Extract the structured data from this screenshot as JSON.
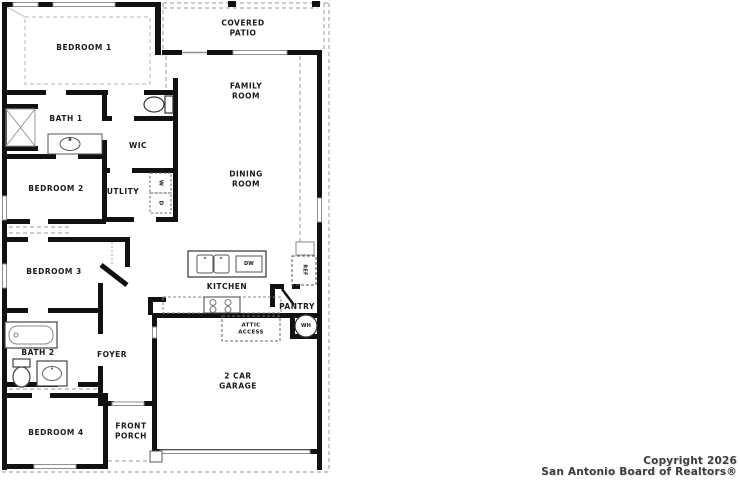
{
  "floorplan": {
    "rooms": {
      "bedroom1": "BEDROOM 1",
      "covered_patio": "COVERED\nPATIO",
      "family_room": "FAMILY\nROOM",
      "bath1": "BATH 1",
      "wic": "WIC",
      "bedroom2": "BEDROOM 2",
      "utility": "UTLITY",
      "dining_room": "DINING\nROOM",
      "bedroom3": "BEDROOM 3",
      "kitchen": "KITCHEN",
      "pantry": "PANTRY",
      "bath2": "BATH 2",
      "foyer": "FOYER",
      "attic_access": "ATTIC\nACCESS",
      "garage": "2 CAR\nGARAGE",
      "bedroom4": "BEDROOM 4",
      "front_porch": "FRONT\nPORCH"
    },
    "appliances": {
      "washer": "W",
      "dryer": "D",
      "dishwasher": "DW",
      "refrigerator": "REF",
      "water_heater": "WH"
    },
    "colors": {
      "wall": "#111111",
      "window": "#999999",
      "dashed_line": "#9a9a9a"
    }
  },
  "footer": {
    "copyright_line1": "Copyright 2026",
    "copyright_line2": "San Antonio Board of Realtors®"
  }
}
